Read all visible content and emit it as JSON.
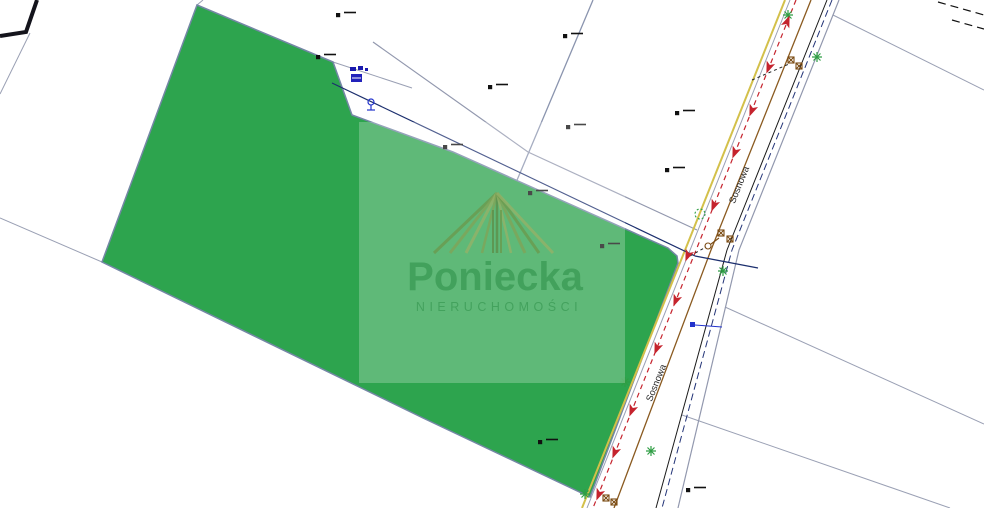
{
  "map": {
    "street_label": "Sosnowa",
    "parcel_color": "#2da44e",
    "road_edge_color": "#d3c04a",
    "traffic_line_color": "#c5232d",
    "utility_line_color": "#1c2f6e",
    "boundary_color": "#9298ae",
    "symbol_green": "#2f9e44",
    "symbol_brown": "#7a4a12",
    "icons": {
      "green_star": "vegetation-star-icon",
      "red_arrow": "flow-arrow-icon",
      "utility_pole": "utility-pole-icon",
      "dash_mark": "survey-dash-icon",
      "hydrant": "hydrant-icon",
      "valve": "valve-icon"
    },
    "symbols": {
      "green_star_positions": [
        [
          788,
          15
        ],
        [
          817,
          57
        ],
        [
          723,
          271
        ],
        [
          625,
          382
        ],
        [
          651,
          451
        ],
        [
          585,
          494
        ]
      ],
      "red_arrow_positions": [
        [
          787,
          22,
          22
        ],
        [
          769,
          67,
          202
        ],
        [
          752,
          110,
          202
        ],
        [
          735,
          152,
          202
        ],
        [
          714,
          205,
          202
        ],
        [
          688,
          255,
          202
        ],
        [
          676,
          300,
          202
        ],
        [
          657,
          348,
          202
        ],
        [
          632,
          410,
          202
        ],
        [
          615,
          452,
          202
        ],
        [
          599,
          494,
          202
        ]
      ],
      "dash_mark_positions": [
        [
          338,
          15
        ],
        [
          318,
          57
        ],
        [
          565,
          36
        ],
        [
          490,
          87
        ],
        [
          568,
          127
        ],
        [
          445,
          147
        ],
        [
          530,
          193
        ],
        [
          677,
          113
        ],
        [
          667,
          170
        ],
        [
          602,
          246
        ],
        [
          540,
          442
        ],
        [
          688,
          490
        ]
      ],
      "utility_pole_positions": [
        [
          791,
          60
        ],
        [
          799,
          66
        ],
        [
          721,
          233
        ],
        [
          730,
          239
        ],
        [
          606,
          498
        ],
        [
          614,
          502
        ]
      ]
    }
  },
  "watermark": {
    "brand": "Poniecka",
    "subtitle": "NIERUCHOMOŚCI",
    "text_color": "#3f9e59"
  }
}
